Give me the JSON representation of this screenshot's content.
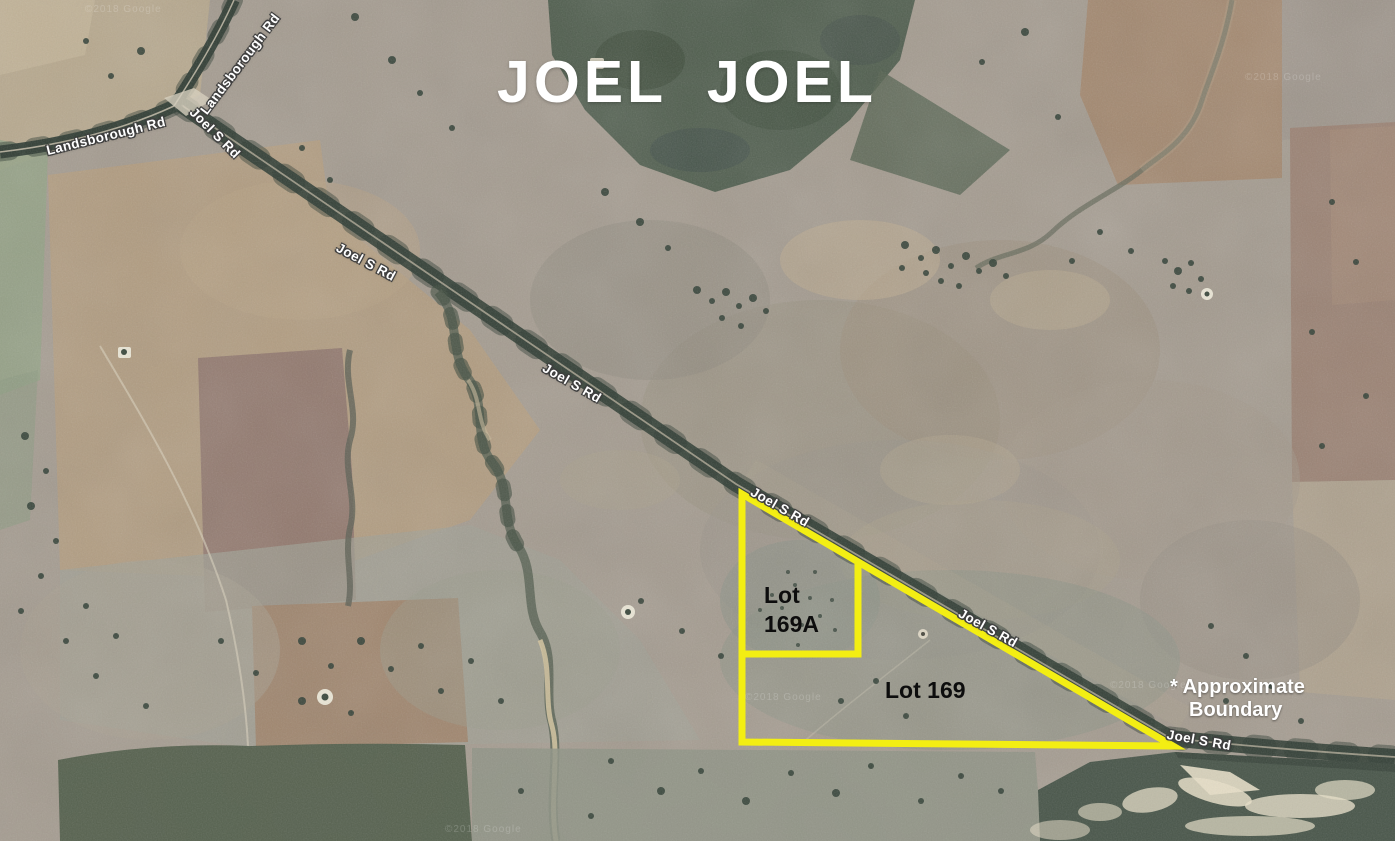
{
  "map": {
    "title": "JOEL  JOEL",
    "title_color": "#ffffff",
    "watermark": "©2018 Google",
    "road_labels": [
      "Landsborough Rd",
      "Landsborough Rd",
      "Joel S Rd",
      "Joel S Rd",
      "Joel S Rd",
      "Joel S Rd",
      "Joel S Rd",
      "Joel S Rd"
    ],
    "lots": {
      "lot_169a": {
        "line1": "Lot",
        "line2": "169A"
      },
      "lot_169": {
        "label": "Lot 169"
      }
    },
    "legend": {
      "line1": "* Approximate",
      "line2": "Boundary"
    },
    "boundary": {
      "color": "#f3ee13",
      "outer_path": "M742,494 L742,742 L1173,746 Z",
      "inner_path": "M858,562 L858,654 L742,654"
    }
  }
}
